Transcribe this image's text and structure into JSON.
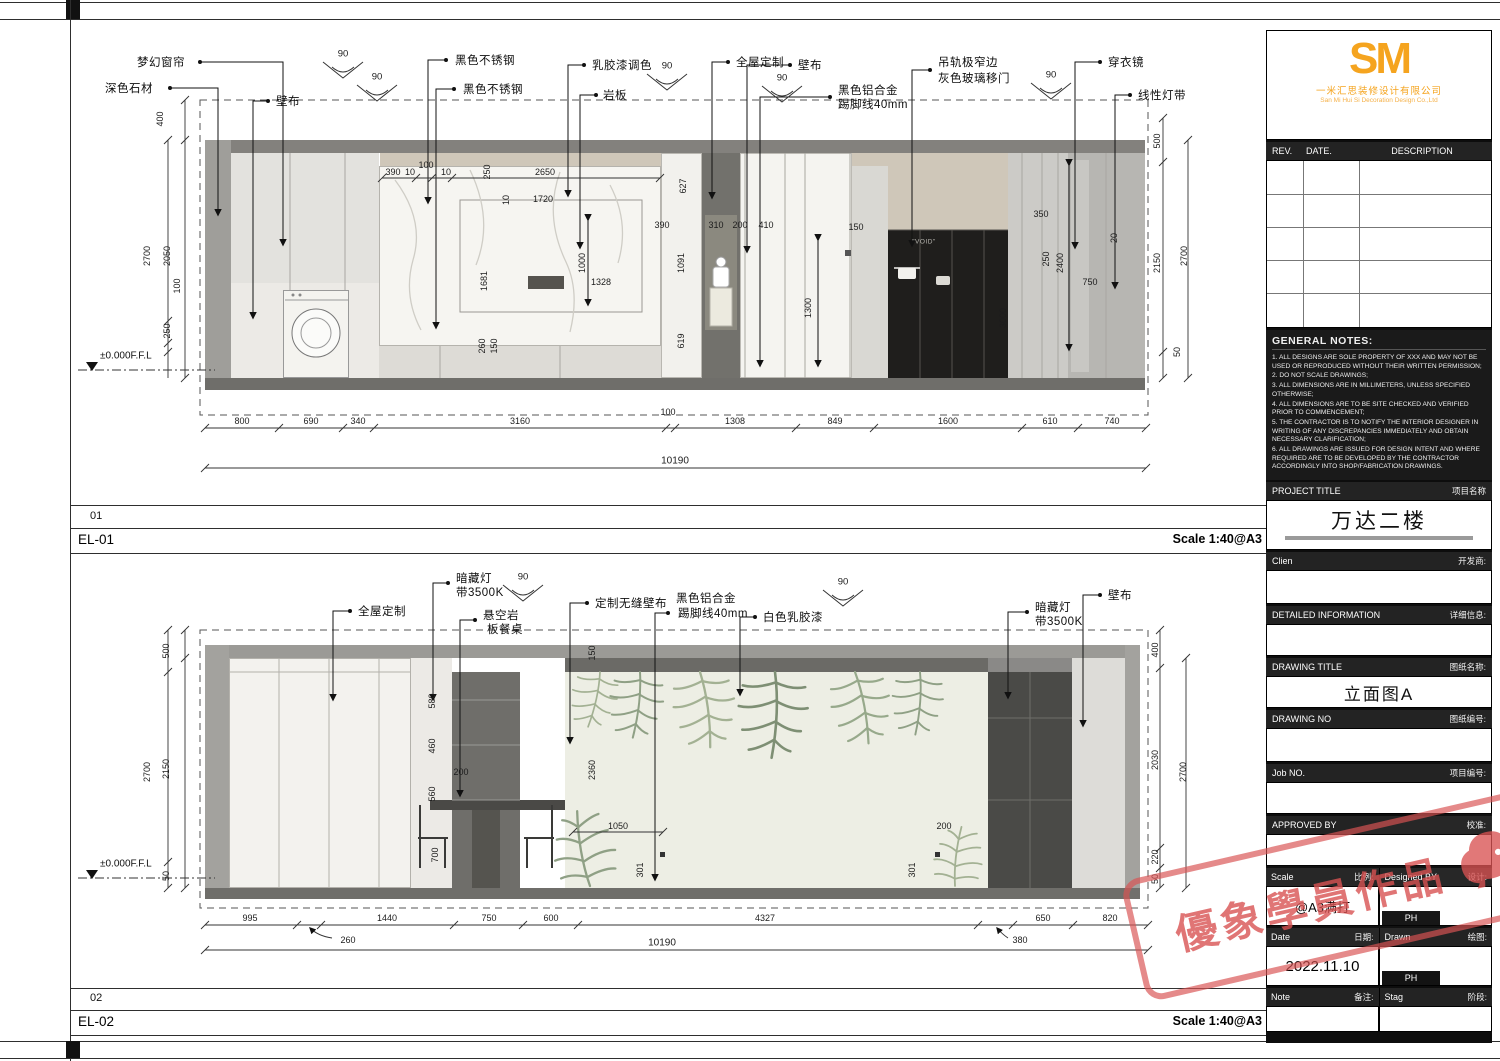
{
  "sheet": {
    "views": [
      {
        "num": "01",
        "code": "EL-01",
        "scale": "Scale 1:40@A3"
      },
      {
        "num": "02",
        "code": "EL-02",
        "scale": "Scale 1:40@A3"
      }
    ]
  },
  "watermark": {
    "text": "優象學員作品"
  },
  "titleblock": {
    "logo_text": "SM",
    "company_cn": "一米汇思装修设计有限公司",
    "company_en": "San Mi Hui Si Decoration Design Co.,Ltd",
    "rev_header": {
      "rev": "REV.",
      "date": "DATE.",
      "desc": "DESCRIPTION"
    },
    "general_notes_title": "GENERAL NOTES:",
    "general_notes": [
      "1. ALL DESIGNS ARE SOLE PROPERTY OF XXX AND MAY NOT BE USED OR REPRODUCED WITHOUT THEIR WRITTEN PERMISSION;",
      "2. DO NOT SCALE DRAWINGS;",
      "3. ALL DIMENSIONS ARE IN MILLIMETERS, UNLESS SPECIFIED OTHERWISE;",
      "4. ALL DIMENSIONS ARE TO BE SITE CHECKED AND VERIFIED PRIOR TO COMMENCEMENT;",
      "5. THE CONTRACTOR IS TO NOTIFY THE INTERIOR DESIGNER IN WRITING OF ANY DISCREPANCIES IMMEDIATELY AND OBTAIN NECESSARY CLARIFICATION;",
      "6. ALL DRAWINGS ARE ISSUED FOR DESIGN INTENT AND WHERE REQUIRED ARE TO BE DEVELOPED BY THE CONTRACTOR ACCORDINGLY INTO SHOP/FABRICATION DRAWINGS."
    ],
    "sections": {
      "project_title": {
        "en": "PROJECT TITLE",
        "cn": "项目名称",
        "value": "万达二楼"
      },
      "client": {
        "en": "Clien",
        "cn": "开发商:"
      },
      "detailed_info": {
        "en": "DETAILED INFORMATION",
        "cn": "详细信息:"
      },
      "drawing_title": {
        "en": "DRAWING TITLE",
        "cn": "图纸名称:",
        "value": "立面图A"
      },
      "drawing_no": {
        "en": "DRAWING NO",
        "cn": "图纸编号:"
      },
      "job_no": {
        "en": "Job NO.",
        "cn": "项目编号:"
      },
      "approved_by": {
        "en": "APPROVED BY",
        "cn": "校准:"
      },
      "scale": {
        "en": "Scale",
        "cn": "比例:",
        "value": "@A3满打"
      },
      "designed_by": {
        "en": "Designed BY",
        "cn": "设计:",
        "value": "PH"
      },
      "date": {
        "en": "Date",
        "cn": "日期:",
        "value": "2022.11.10"
      },
      "drawn": {
        "en": "Drawn",
        "cn": "绘图:",
        "value": "PH"
      },
      "note": {
        "en": "Note",
        "cn": "备注:"
      },
      "stage": {
        "en": "Stag",
        "cn": "阶段:"
      }
    }
  },
  "el01": {
    "angle": "90",
    "level": "±0.000F.F.L",
    "void_label": "\"VOID\"",
    "labels": {
      "curtain": "梦幻窗帘",
      "stone": "深色石材",
      "wall_left": "壁布",
      "steel_top": "黑色不锈钢",
      "steel_mid": "黑色不锈钢",
      "paint": "乳胶漆调色",
      "slate": "岩板",
      "custom": "全屋定制",
      "wall_mid": "壁布",
      "skirting_l1": "黑色铝合金",
      "skirting_l2": "踢脚线40mm",
      "door_l1": "吊轨极窄边",
      "door_l2": "灰色玻璃移门",
      "mirror": "穿衣镜",
      "led": "线性灯带"
    },
    "dims": {
      "bottom": [
        "800",
        "690",
        "340",
        "3160",
        "100",
        "1308",
        "849",
        "1600",
        "610",
        "740"
      ],
      "total": "10190",
      "left": [
        "400",
        "2700",
        "2050",
        "250",
        "100"
      ],
      "right": [
        "500",
        "2150",
        "2700",
        "50"
      ],
      "inner": [
        "390",
        "10",
        "100",
        "10",
        "250",
        "2650",
        "1720",
        "10",
        "1681",
        "1000",
        "1328",
        "260",
        "150",
        "627",
        "390",
        "310",
        "200",
        "410",
        "1091",
        "619",
        "1300",
        "150",
        "3000",
        "350",
        "250",
        "2400",
        "750",
        "20"
      ]
    }
  },
  "el02": {
    "angle": "90",
    "level": "±0.000F.F.L",
    "labels": {
      "custom": "全屋定制",
      "light_l1": "暗藏灯",
      "light_l2": "带3500K",
      "table_1": "悬空岩",
      "table_2": "板餐桌",
      "seamless": "定制无缝壁布",
      "skirting_1": "黑色铝合金",
      "skirting_2": "踢脚线40mm",
      "white_paint": "白色乳胶漆",
      "light_r1": "暗藏灯",
      "light_r2": "带3500K",
      "wall": "壁布"
    },
    "dims": {
      "bottom": [
        "995",
        "1440",
        "750",
        "600",
        "4327",
        "650",
        "820"
      ],
      "total": "10190",
      "sub_left": "260",
      "sub_right": "380",
      "left": [
        "500",
        "2700",
        "2150",
        "50"
      ],
      "right": [
        "400",
        "2030",
        "2700",
        "220",
        "50"
      ],
      "inner": [
        "580",
        "460",
        "560",
        "200",
        "700",
        "1050",
        "301",
        "2360",
        "150",
        "301",
        "200"
      ]
    }
  }
}
